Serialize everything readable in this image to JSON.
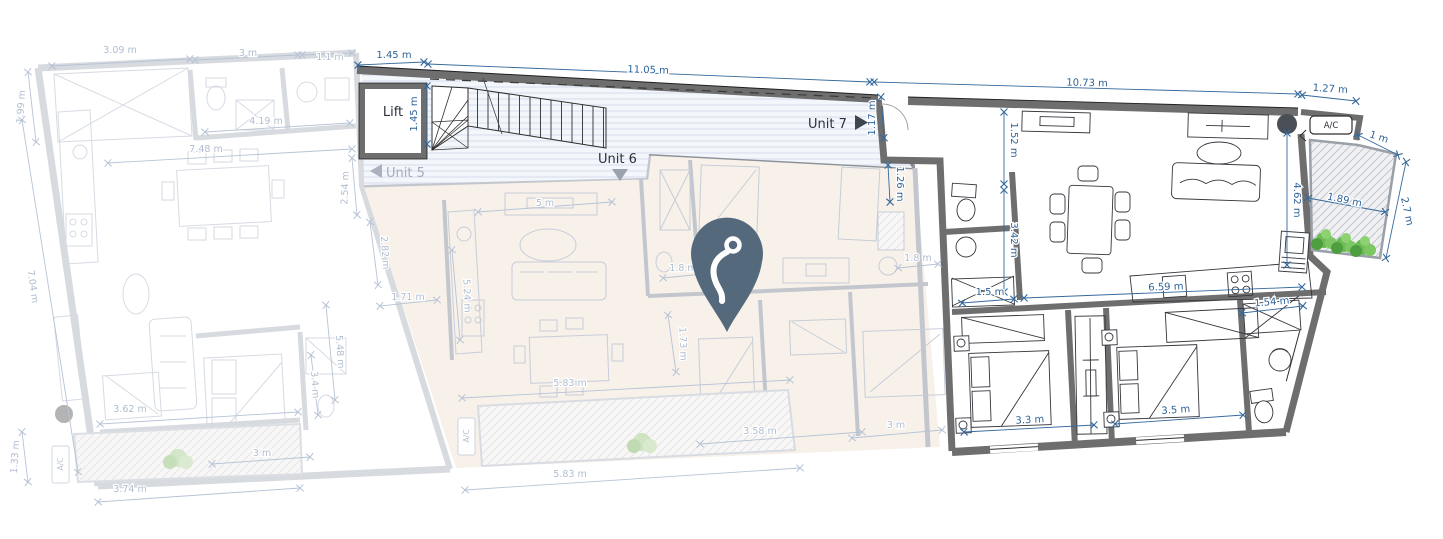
{
  "labels": {
    "unit5": "Unit 5",
    "unit6": "Unit 6",
    "unit7": "Unit 7",
    "lift": "Lift",
    "ac_top_right": "A/C",
    "ac_unit6_balcony": "A/C",
    "ac_unit5_balcony": "A/C"
  },
  "dims": {
    "lift_top_w": "1.45 m",
    "corridor_len": "11.05 m",
    "unit7_top_len": "10.73 m",
    "terrace_top_w": "1.27 m",
    "lift_side": "1.45 m",
    "entry_w": "1.17 m",
    "u6_bed_right": "1.26 m",
    "hall_d": "1.52 m",
    "bath_d": "3.42 m",
    "bath_w": "1.5 m",
    "kitchen_len": "6.59 m",
    "closet_w": "1.54 m",
    "bedroom_a_w": "3.3 m",
    "bedroom_b_w": "3.5 m",
    "living_d": "4.62 m",
    "terrace_niche": "1 m",
    "terrace_w": "1.89 m",
    "terrace_d": "2.7 m",
    "u5_top_a": "3.09 m",
    "u5_top_b": "3 m",
    "u5_top_c": "1.1 m",
    "u5_left_top": "1.99 m",
    "u5_bath_top": "4.19 m",
    "u5_living_top": "7.48 m",
    "u5_right_top": "2.54 m",
    "u5_left_side": "7.04 m",
    "u5_mid_a": "2.82 m",
    "u5_mid_b": "1.71 m",
    "u5_mid_c": "5.48 m",
    "u5_mid_d": "3.4 m",
    "u5_living_w": "3.62 m",
    "u5_balcony_d": "1.33 m",
    "u5_balcony_w": "3.74 m",
    "u5_bed_w": "3 m",
    "u6_living_top": "5 m",
    "u6_kitchen_d": "5.24 m",
    "u6_living_w": "5.83 m",
    "u6_balcony_w": "5.83 m",
    "u6_bed_bottom": "3.58 m",
    "u6_shower_w": "1.8 m",
    "u6_hall_w": "1.8 m",
    "u6_mid_d": "1.73 m",
    "u6_bed3_w": "3 m"
  },
  "colors": {
    "dimension_blue": "#34699c",
    "faded_dimension": "#b6c3d6",
    "pin": "#54697c",
    "active_wall": "#757575",
    "unit6_floor": "#f7f0e9",
    "plant_green": "#5fae4a"
  }
}
